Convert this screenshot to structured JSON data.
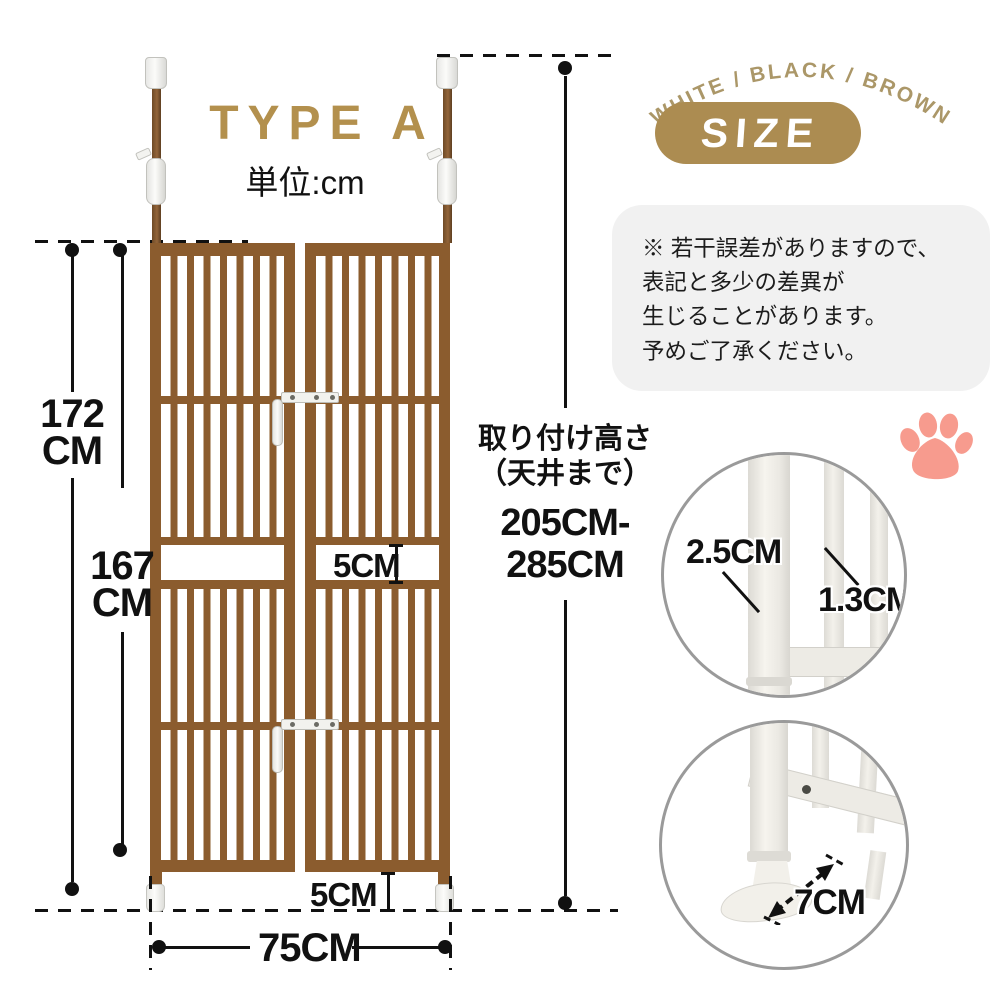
{
  "header": {
    "title": "TYPE A",
    "unit": "単位:cm",
    "color_options": "WHITE / BLACK / BROWN",
    "size_badge": "SIZE"
  },
  "note": {
    "line1": "※ 若干誤差がありますので、",
    "line2": "表記と多少の差異が",
    "line3": "生じることがあります。",
    "line4": "予めご了承ください。"
  },
  "dimensions": {
    "total_height_value": "172",
    "total_height_unit": "CM",
    "panel_height_value": "167",
    "panel_height_unit": "CM",
    "mid_gap": "5CM",
    "bottom_gap": "5CM",
    "width": "75CM",
    "install_height_label_line1": "取り付け高さ",
    "install_height_label_line2": "（天井まで）",
    "install_height_range_line1": "205CM-",
    "install_height_range_line2": "285CM"
  },
  "details": {
    "pole_diameter": "2.5CM",
    "bar_diameter": "1.3CM",
    "base_depth": "7CM"
  },
  "colors": {
    "gold_accent": "#B3904D",
    "pill_gold": "#AC8C51",
    "arc_text_gold": "#AB9768",
    "gate_brown": "#8B5C2E",
    "paw_pink": "#F79B8E",
    "note_background": "#F1F1F1",
    "dimension_line": "#111111"
  }
}
